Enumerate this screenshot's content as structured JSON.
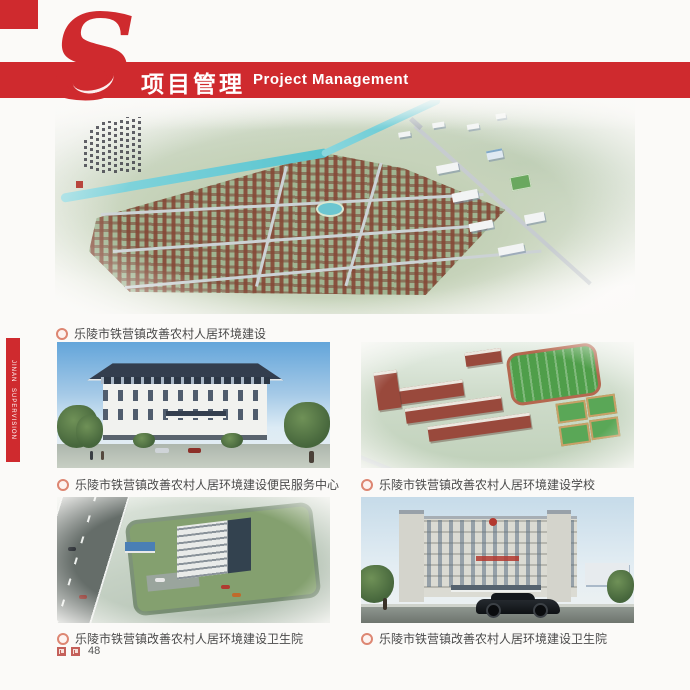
{
  "header": {
    "logo_letter": "S",
    "title_zh": "项目管理",
    "title_en": "Project Management"
  },
  "side_tab": {
    "line1": "JINAN",
    "line2": "SUPERVISION"
  },
  "figures": {
    "main_caption": "乐陵市铁营镇改善农村人居环境建设",
    "grid": [
      {
        "caption": "乐陵市铁营镇改善农村人居环境建设便民服务中心"
      },
      {
        "caption": "乐陵市铁营镇改善农村人居环境建设学校"
      },
      {
        "caption": "乐陵市铁营镇改善农村人居环境建设卫生院"
      },
      {
        "caption": "乐陵市铁营镇改善农村人居环境建设卫生院"
      }
    ]
  },
  "footer": {
    "page_number": "48",
    "marks": [
      "maze-square-icon",
      "maze-square-icon"
    ]
  },
  "colors": {
    "accent_red": "#cf2a2e",
    "river_teal": "#58c4cf"
  }
}
